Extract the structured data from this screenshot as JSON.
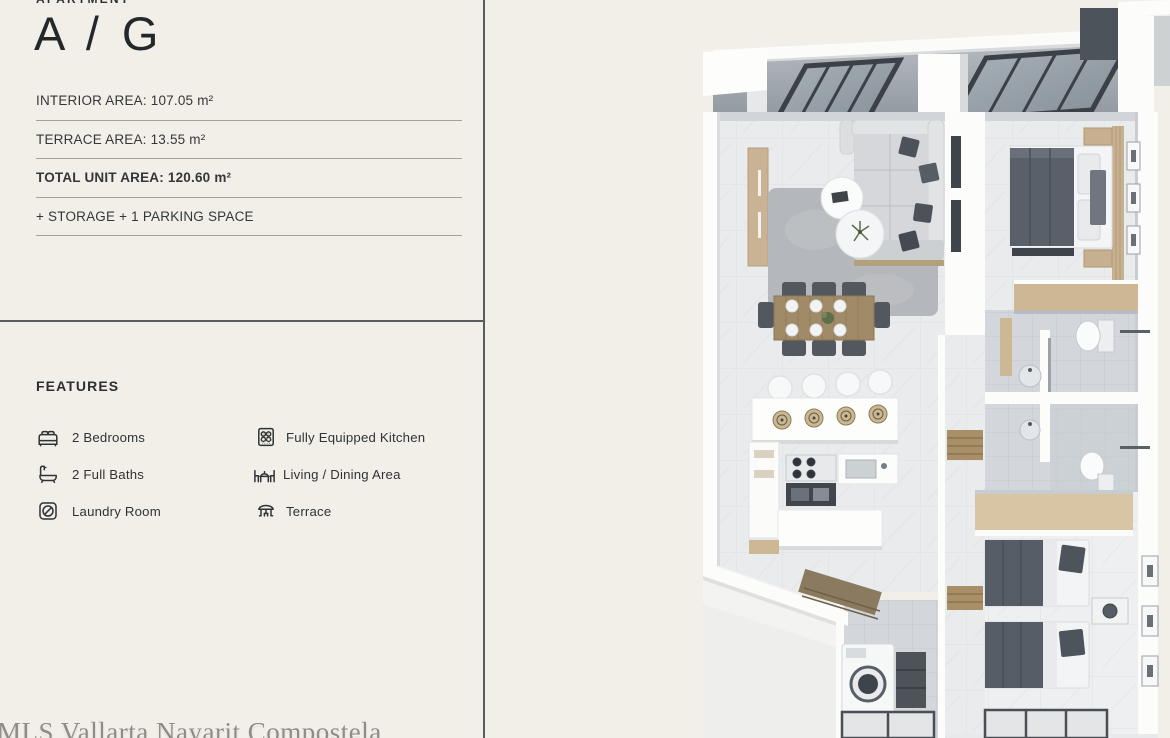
{
  "page": {
    "background": "#f2efe9",
    "divider_color": "#595c5e"
  },
  "header": {
    "eyebrow": "APARTMENT",
    "title": "A / G"
  },
  "specs": {
    "rows": [
      {
        "label": "INTERIOR AREA: 107.05 m²"
      },
      {
        "label": "TERRACE AREA: 13.55 m²"
      },
      {
        "label": "TOTAL UNIT AREA: 120.60 m²"
      },
      {
        "label": "+ STORAGE + 1 PARKING SPACE"
      }
    ]
  },
  "features": {
    "heading": "FEATURES",
    "left": [
      {
        "icon": "bed-icon",
        "label": "2 Bedrooms"
      },
      {
        "icon": "bathtub-icon",
        "label": "2 Full Baths"
      },
      {
        "icon": "washing-machine-icon",
        "label": "Laundry Room"
      }
    ],
    "right": [
      {
        "icon": "stove-icon",
        "label": "Fully Equipped Kitchen"
      },
      {
        "icon": "dining-table-icon",
        "label": "Living / Dining Area"
      },
      {
        "icon": "umbrella-icon",
        "label": "Terrace"
      }
    ]
  },
  "watermark": {
    "text": "MLS Vallarta Nayarit Compostela"
  },
  "floor_plan": {
    "kind": "3d-top-view-apartment-render",
    "colors": {
      "wall": "#fcfcfb",
      "floor_marble": "#e9ebed",
      "bath_tile": "#d3d7db",
      "wood": "#c9b394",
      "dark_furniture": "#575d66",
      "glass_roof": "#99a2aa",
      "glass_frame": "#3c4147"
    }
  }
}
